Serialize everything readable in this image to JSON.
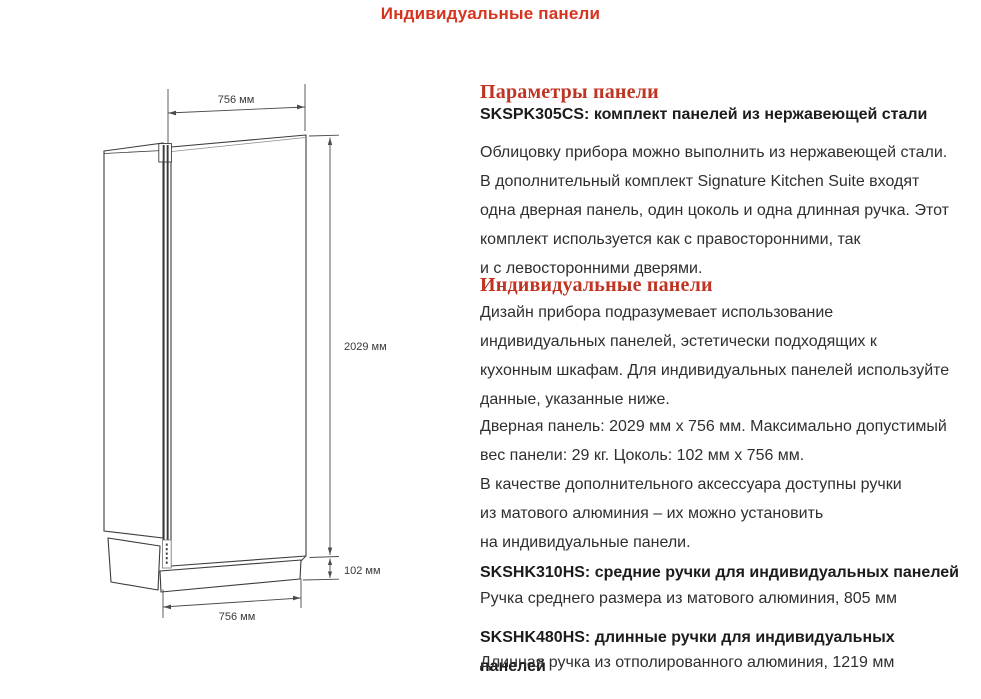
{
  "page_title": "Индивидуальные панели",
  "colors": {
    "title_red": "#d6341f",
    "heading_red": "#bf3422",
    "body_text": "#2f2f2f",
    "line_art": "#3b3b3b"
  },
  "diagram": {
    "dim_top_width": "756 мм",
    "dim_height": "2029 мм",
    "dim_plinth_height": "102 мм",
    "dim_bottom_width": "756 мм"
  },
  "sections": {
    "panel_params": {
      "heading": "Параметры панели",
      "subheading": "SKSPK305CS: комплект панелей из нержавеющей стали",
      "body": "Облицовку прибора можно выполнить из нержавеющей стали.\nВ дополнительный комплект Signature Kitchen Suite входят\nодна дверная панель, один цоколь и одна длинная ручка. Этот\nкомплект используется как с правосторонними, так\nи с левосторонними дверями."
    },
    "custom_panels": {
      "heading": "Индивидуальные панели",
      "body1": "Дизайн прибора подразумевает использование\nиндивидуальных панелей, эстетически подходящих к\nкухонным шкафам. Для индивидуальных панелей используйте\nданные, указанные ниже.",
      "body2": "Дверная панель: 2029 мм x 756 мм. Максимально допустимый\nвес панели: 29 кг. Цоколь: 102 мм x 756 мм.",
      "body3": "В качестве дополнительного аксессуара доступны ручки\nиз матового алюминия – их можно установить\nна индивидуальные панели."
    },
    "handles": [
      {
        "heading": "SKSHK310HS: средние ручки для индивидуальных панелей",
        "body": "Ручка среднего размера из матового алюминия, 805 мм"
      },
      {
        "heading": "SKSHK480HS: длинные ручки для индивидуальных панелей",
        "body": "Длинная ручка из отполированного алюминия, 1219 мм"
      }
    ]
  }
}
